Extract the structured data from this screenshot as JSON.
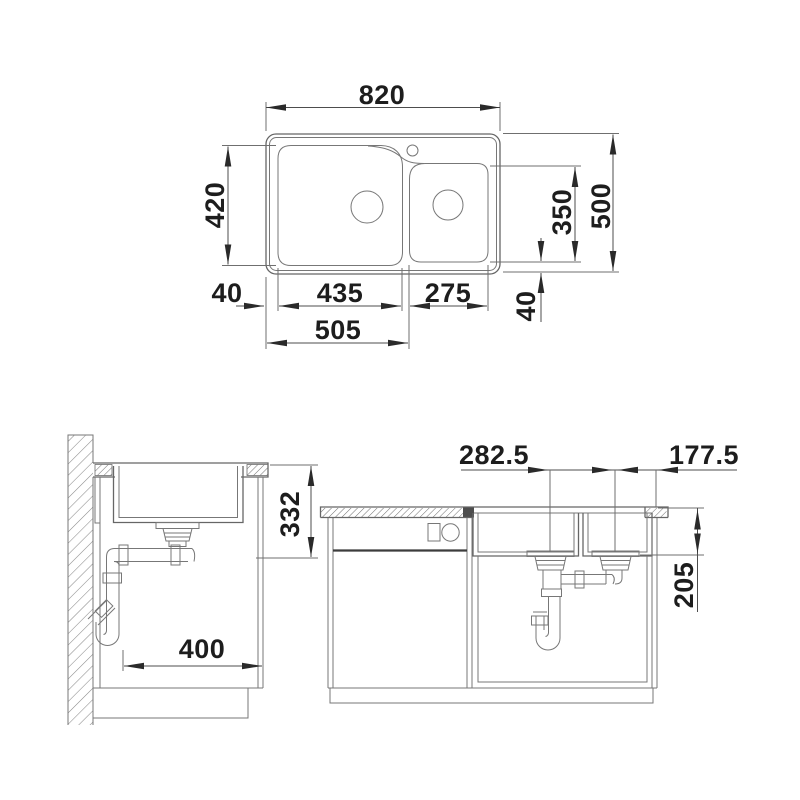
{
  "drawing": {
    "background": "#ffffff",
    "line_color": "#6e6e6e",
    "arrow_color": "#2a2a2a",
    "text_color": "#1d1d1d",
    "views": {
      "plan": {
        "dims": {
          "overall_width": "820",
          "overall_depth": "500",
          "main_bowl_depth": "420",
          "small_bowl_depth": "350",
          "left_edge_offset": "40",
          "main_bowl_width": "435",
          "small_bowl_width": "275",
          "bottom_edge_offset": "40",
          "left_edge_to_small_bowl": "505"
        }
      },
      "side_section": {
        "dims": {
          "countertop_to_trap": "332",
          "wall_to_front_clearance": "400"
        }
      },
      "front_section": {
        "dims": {
          "bowl_center_spacing": "282.5",
          "small_bowl_center_to_edge": "177.5",
          "bowl_depth": "205"
        }
      }
    }
  }
}
